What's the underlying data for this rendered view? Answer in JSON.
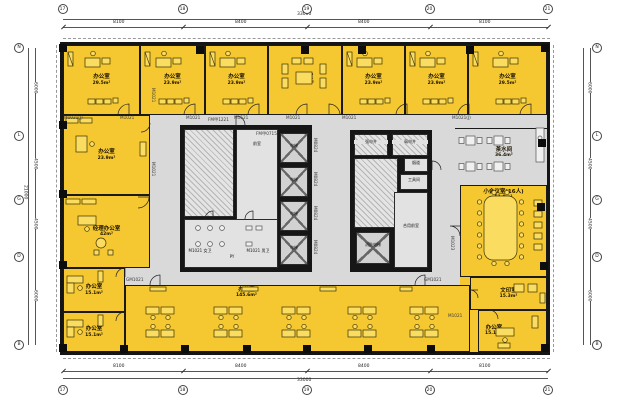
{
  "colors": {
    "room_fill": "#f5c832",
    "core_fill": "#d9d9d9",
    "wall": "#151515"
  },
  "grid": {
    "cols": [
      "17",
      "18",
      "19",
      "20",
      "21"
    ],
    "rows": [
      "N",
      "L",
      "G",
      "D",
      "B"
    ],
    "col_dims": [
      "8100",
      "8400",
      "8400",
      "8100"
    ],
    "row_dims": [
      "6000",
      "4500",
      "4500",
      "6000"
    ],
    "total_w": "33000",
    "total_h": "21000"
  },
  "rooms": [
    {
      "name": "办公室",
      "area": "29.5m²"
    },
    {
      "name": "办公室",
      "area": "23.9m²"
    },
    {
      "name": "办公室",
      "area": "23.9m²"
    },
    {
      "name": "会客室",
      "area": "28.4m²"
    },
    {
      "name": "办公室",
      "area": "23.9m²"
    },
    {
      "name": "办公室",
      "area": "23.9m²"
    },
    {
      "name": "办公室",
      "area": "29.5m²"
    },
    {
      "name": "办公室",
      "area": "23.9m²"
    },
    {
      "name": "经理办公室",
      "area": "42m²"
    },
    {
      "name": "办公室",
      "area": "15.1m²"
    },
    {
      "name": "办公室",
      "area": "15.1m²"
    },
    {
      "name": "办公室",
      "area": "145.6m²"
    },
    {
      "name": "茶水间",
      "area": "36.4m²"
    },
    {
      "name": "小会议室(16人)",
      "area": "51.9m²"
    },
    {
      "name": "文印室",
      "area": "15.3m²"
    },
    {
      "name": "办公室",
      "area": "15.1m²"
    }
  ],
  "core": {
    "vestibule": "前室",
    "women": "M1021 女卫",
    "men": "M1021 男卫",
    "shaft": "PY",
    "elevator": "电梯",
    "strong_elec": "强电井",
    "weak_elec": "弱电井",
    "smoke": "烟道",
    "tools": "工具间",
    "fire_elevator": "消防电梯",
    "shared_vestibule": "合用前室"
  },
  "doors": [
    "M1021(J)",
    "M1021",
    "M1021",
    "M1521",
    "M1021",
    "M1021",
    "M1021(J)",
    "M1021",
    "M1021",
    "GM1021",
    "GM1021",
    "M1021",
    "M1023",
    "FM甲1221",
    "FM甲0715",
    "M0824",
    "M0824",
    "M0824",
    "M0824"
  ]
}
